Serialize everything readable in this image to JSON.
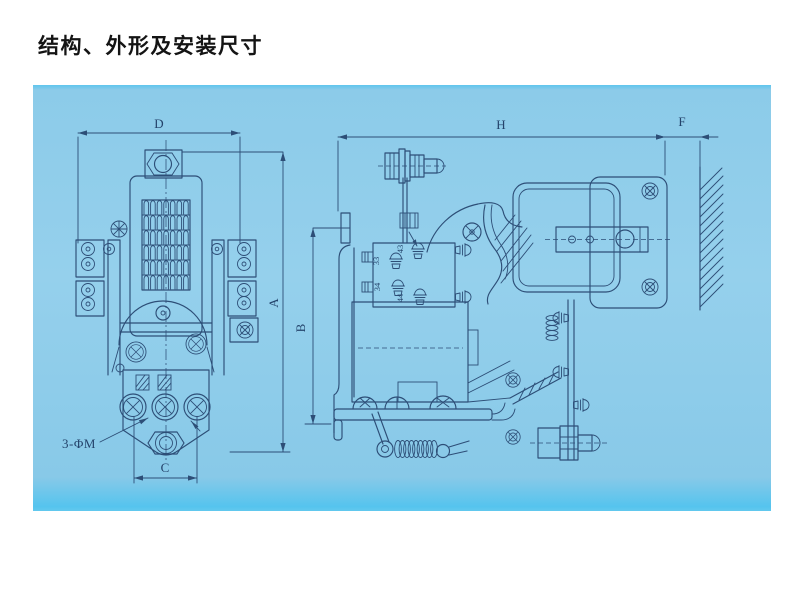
{
  "title": "结构、外形及安装尺寸",
  "colors": {
    "panel": "#8ccae9",
    "line": "#2d4e77",
    "title": "#141414"
  },
  "front_view": {
    "dim_width": "D",
    "dim_height": "A",
    "dim_hole_span": "C",
    "hole_note": "3-ΦM"
  },
  "side_view": {
    "dim_width": "H",
    "dim_height": "B",
    "dim_gap": "F",
    "terminal_labels": [
      "43",
      "33",
      "34",
      "44"
    ]
  }
}
